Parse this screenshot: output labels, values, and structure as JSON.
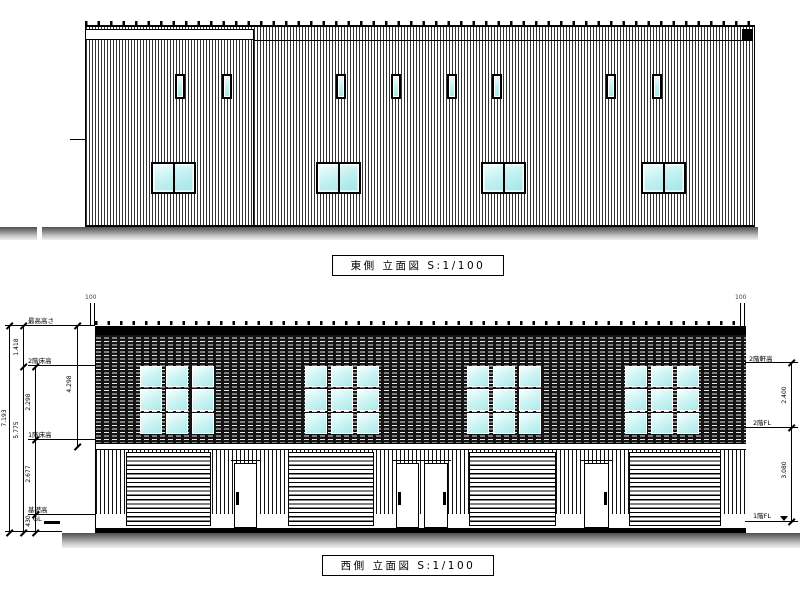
{
  "east_elevation": {
    "title": "東側 立面図 S:1/100"
  },
  "west_elevation": {
    "title": "西側 立面図 S:1/100",
    "pipes": {
      "left_label": "100",
      "right_label": "100"
    },
    "levels_left": {
      "max_height": "最高高さ",
      "floor2": "2階床高",
      "floor1": "1階床高",
      "foundation": "基礎高",
      "ground": "GL"
    },
    "dims_left": {
      "total": "7.193",
      "parapet": "1.418",
      "below_floor2": "5.775",
      "floor2_to_floor1": "2.298",
      "floor1_to_foundation": "2.677",
      "foundation_to_gl": "430",
      "inner": "4.298"
    },
    "levels_right": {
      "eave2": "2階軒高",
      "floor2": "2階FL",
      "floor1": "1階FL"
    },
    "dims_right": {
      "upper": "2.400",
      "lower": "3.080"
    }
  },
  "colors": {
    "line": "#000000",
    "glass": "#c7f1f1",
    "ground": "#777777",
    "wall_dark": "#141414"
  }
}
